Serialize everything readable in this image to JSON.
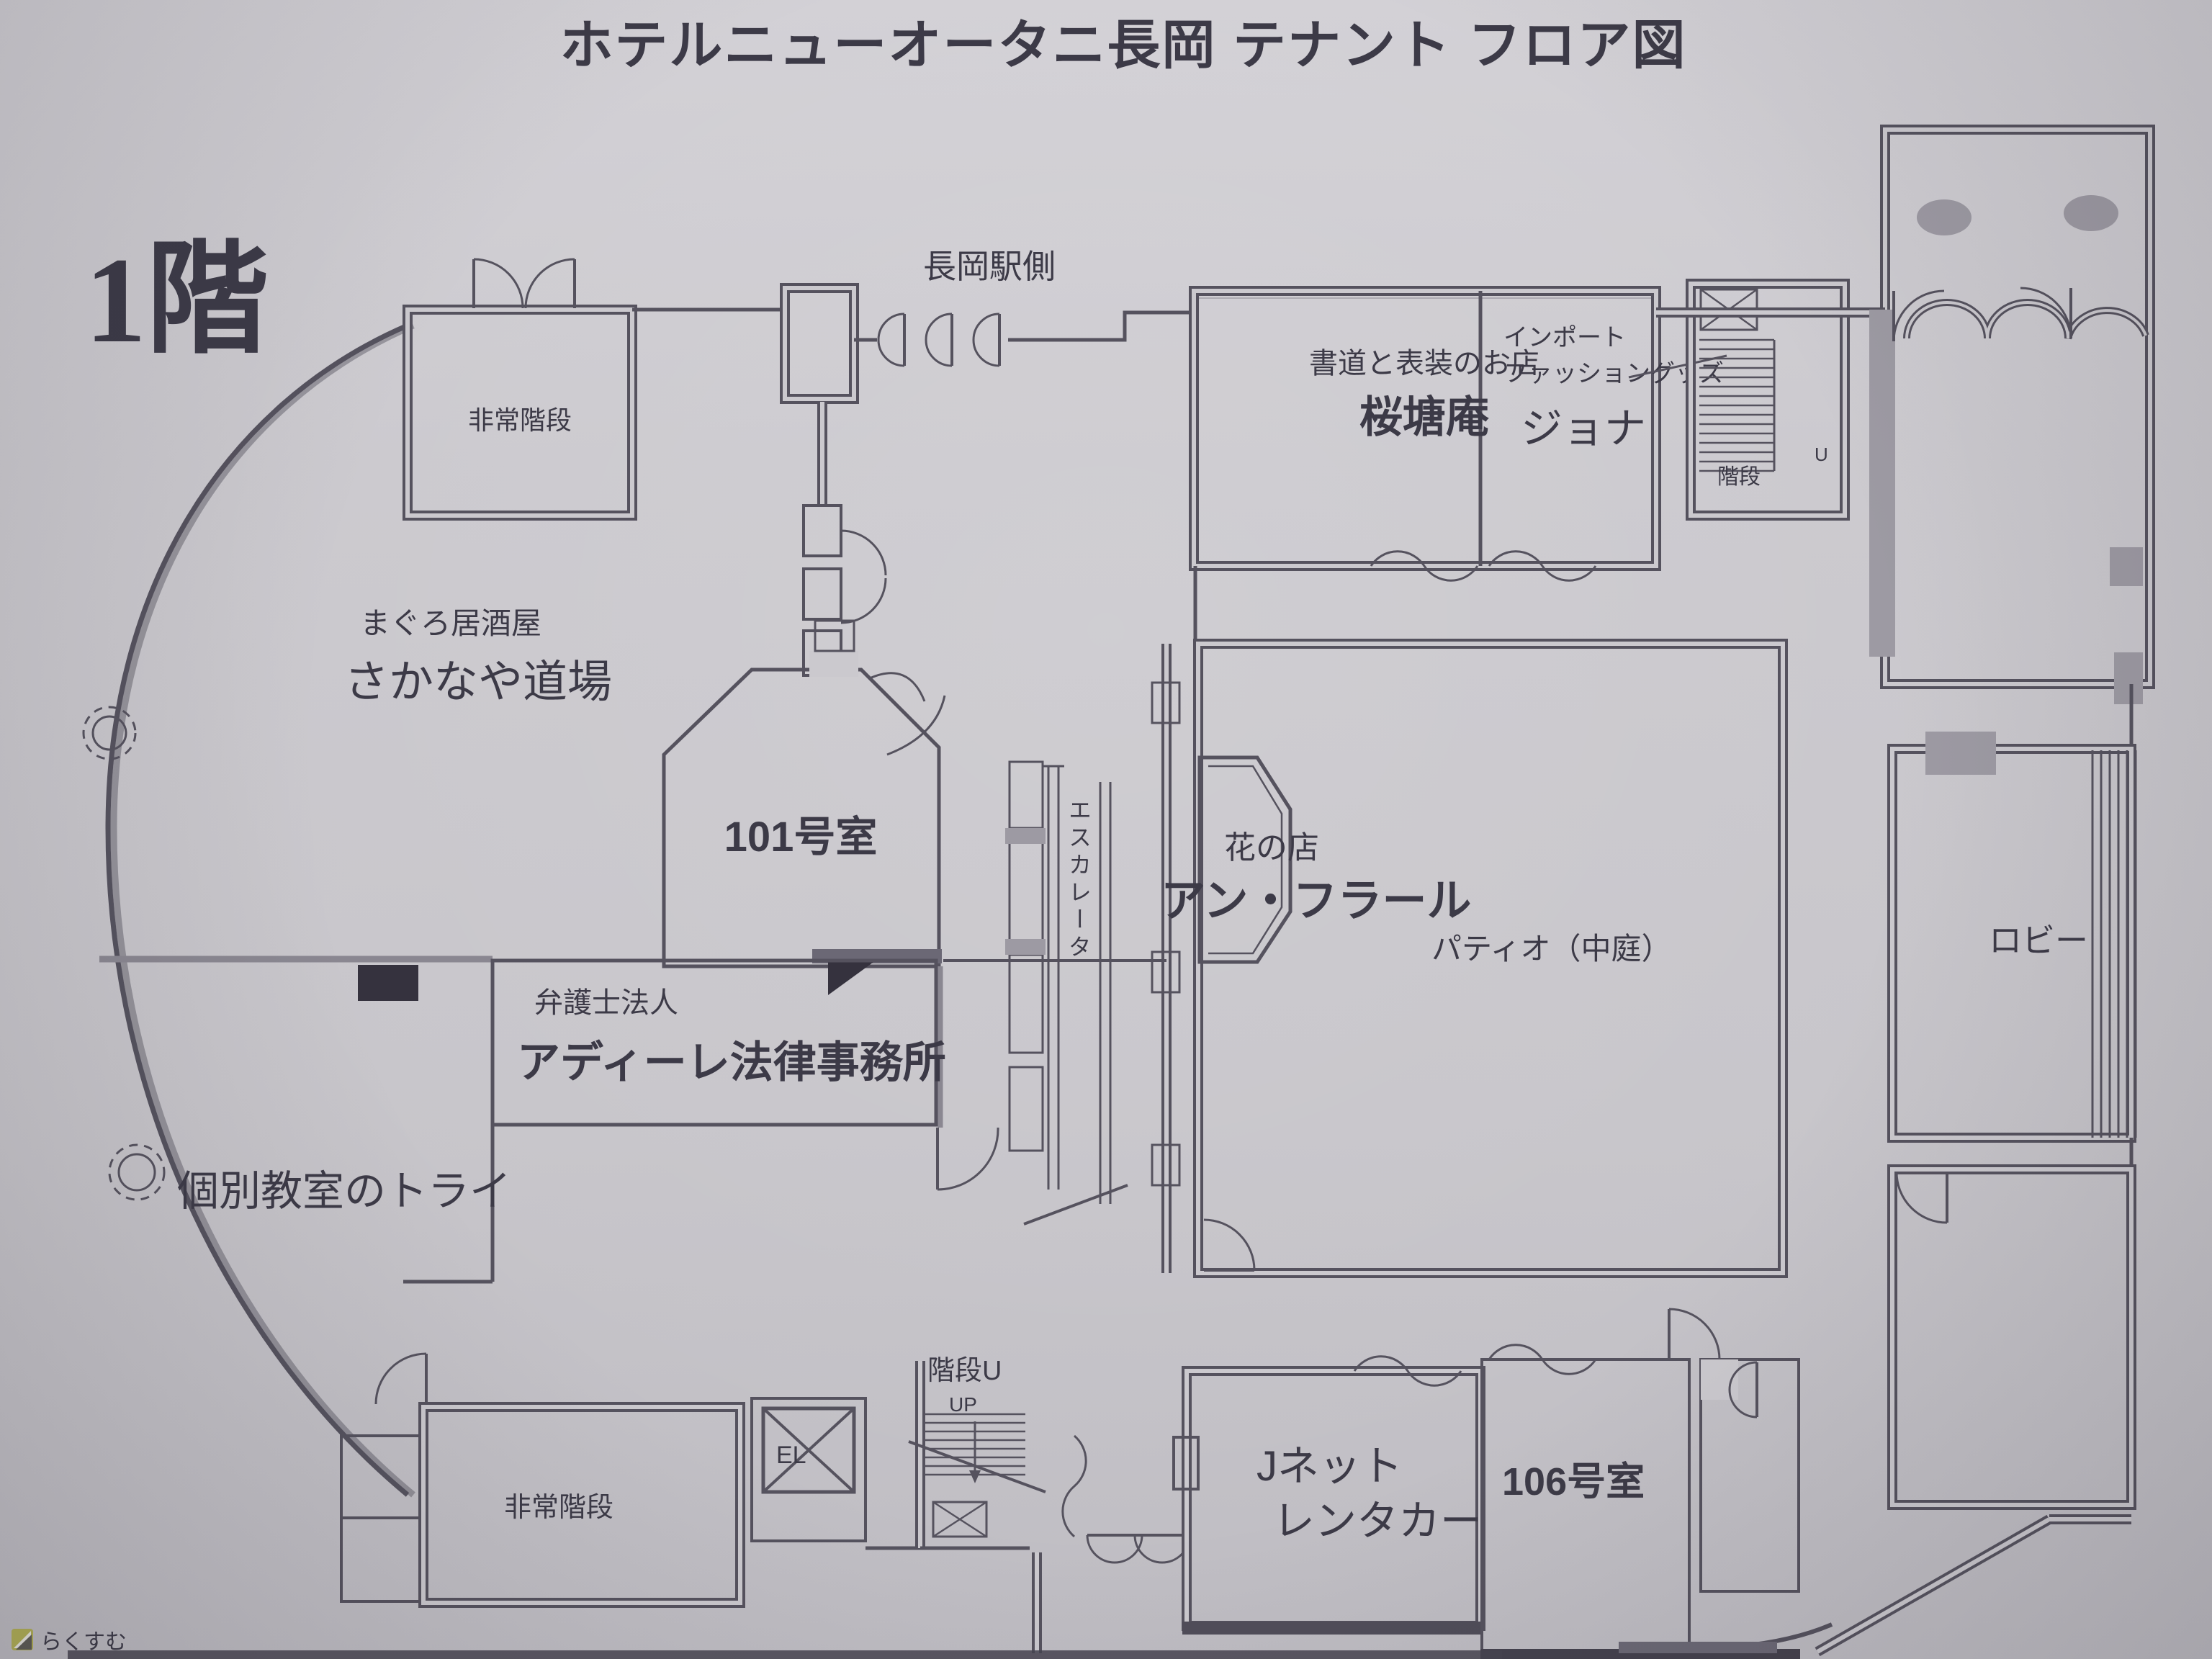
{
  "title": "ホテルニューオータニ長岡 テナント フロア図",
  "floor": "1階",
  "station_side": "長岡駅側",
  "labels": {
    "emergency_stairs_top": "非常階段",
    "izakaya_sub": "まぐろ居酒屋",
    "izakaya_name": "さかなや道場",
    "room101": "101号室",
    "calligraphy_sub": "書道と表装のお店",
    "calligraphy_name": "桜塘庵",
    "import_sub1": "インポート",
    "import_sub2": "ファッショングッズ",
    "import_name": "ジョナ",
    "stairs_northeast": "階段",
    "stairs_northeast_u": "U",
    "flower_sub": "花の店",
    "flower_name": "アン・フラール",
    "escalator": "エスカレータ",
    "patio": "パティオ（中庭）",
    "lobby": "ロビー",
    "law_sub": "弁護士法人",
    "law_name": "アディーレ法律事務所",
    "tutoring_name": "個別教室のトライ",
    "emergency_stairs_bottom": "非常階段",
    "elevator": "EL",
    "stairs_center": "階段U",
    "stairs_center_up": "UP",
    "rentacar_line1": "Jネット",
    "rentacar_line2": "レンタカー",
    "room106": "106号室"
  },
  "watermark": "らくすむ",
  "colors": {
    "paper": "#cbc9ce",
    "ink": "#55525e",
    "text": "#3c3a47",
    "room_pink_101": "#d5a5c5",
    "room_pink_106": "#cd8db7",
    "wall_gray": "#9d9aa3",
    "watermark_olive": "#b3b156"
  }
}
